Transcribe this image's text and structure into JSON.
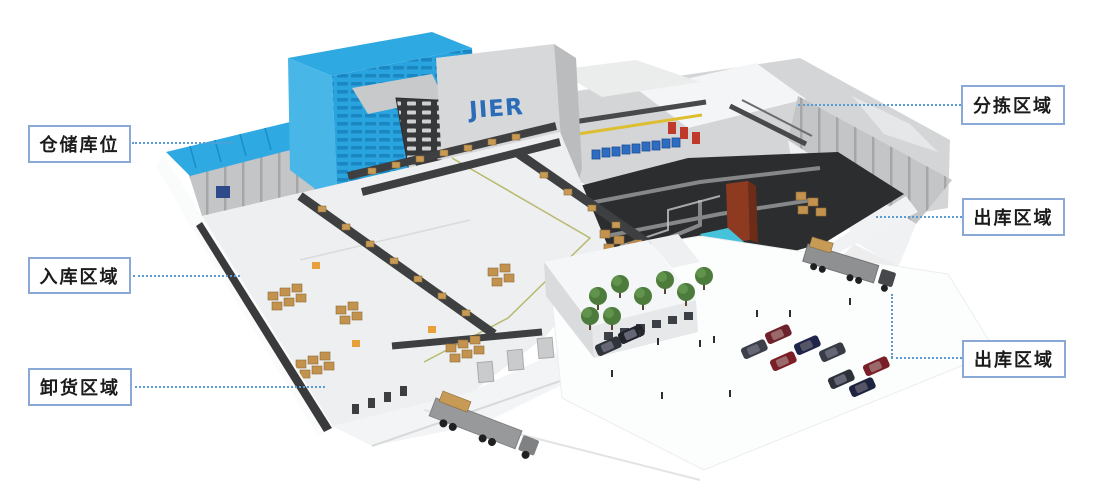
{
  "scene": {
    "logo_text": "JIER",
    "colors": {
      "label_border": "#8aa9d6",
      "label_text": "#1b1b1b",
      "leader_line": "#5b9bd5",
      "building_blue": "#2fa9e2",
      "logo_blue": "#2a6cb8"
    }
  },
  "labels": [
    {
      "id": "storage-location",
      "text": "仓储库位"
    },
    {
      "id": "inbound-area",
      "text": "入库区域"
    },
    {
      "id": "unloading-area",
      "text": "卸货区域"
    },
    {
      "id": "sorting-area",
      "text": "分拣区域"
    },
    {
      "id": "outbound-area-upper",
      "text": "出库区域"
    },
    {
      "id": "outbound-area-lower",
      "text": "出库区域"
    }
  ]
}
